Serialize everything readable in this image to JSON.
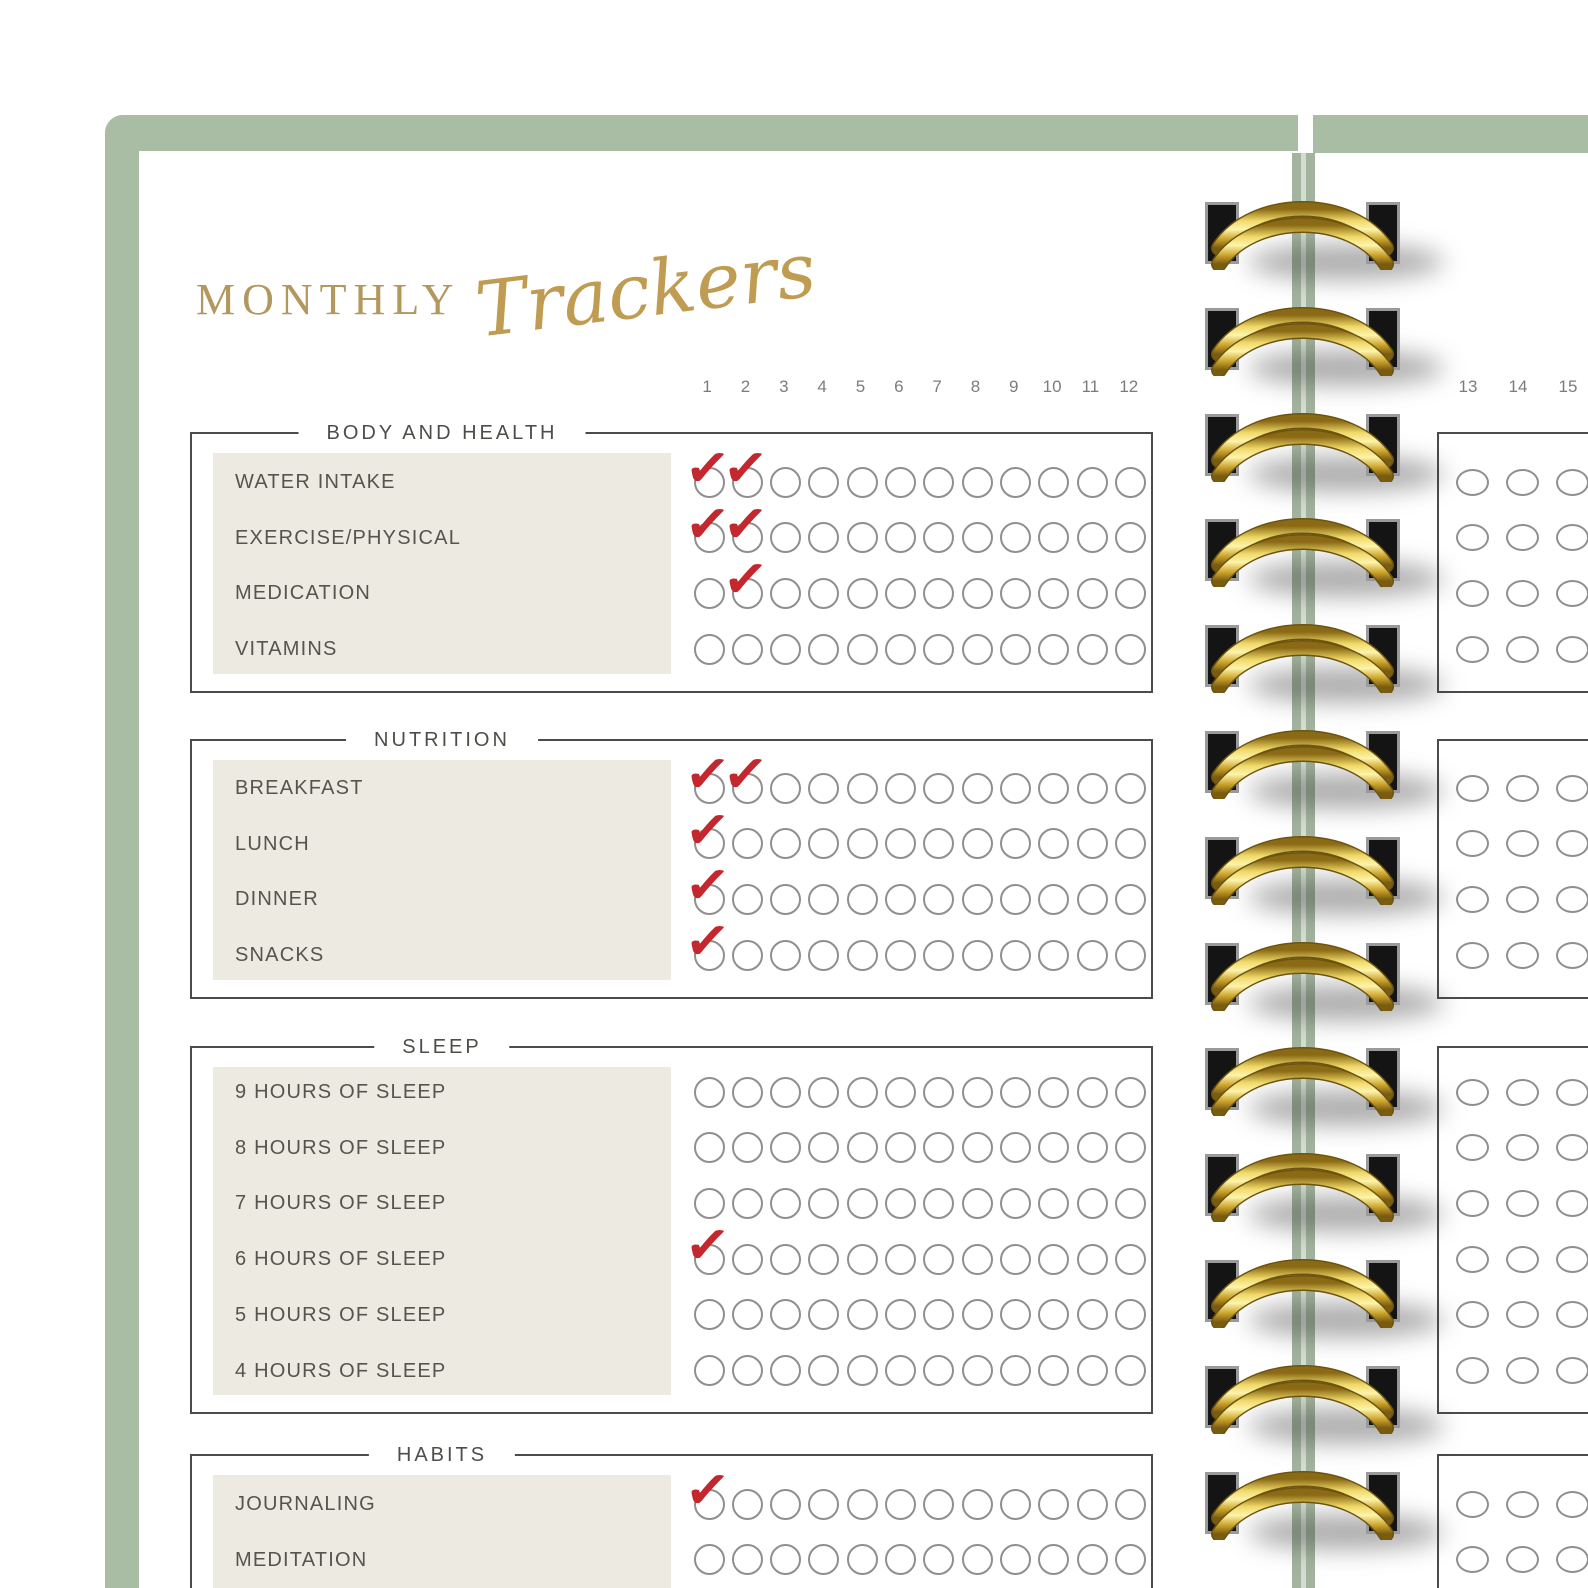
{
  "title": {
    "word_serif": "MONTHLY",
    "word_script": "Trackers"
  },
  "left_page": {
    "day_numbers": [
      "1",
      "2",
      "3",
      "4",
      "5",
      "6",
      "7",
      "8",
      "9",
      "10",
      "11",
      "12"
    ],
    "sections": [
      {
        "title": "BODY AND HEALTH",
        "rows": [
          {
            "label": "WATER INTAKE",
            "checked_days": [
              1,
              2
            ]
          },
          {
            "label": "EXERCISE/PHYSICAL",
            "checked_days": [
              1,
              2
            ]
          },
          {
            "label": "MEDICATION",
            "checked_days": [
              2
            ]
          },
          {
            "label": "VITAMINS",
            "checked_days": []
          }
        ]
      },
      {
        "title": "NUTRITION",
        "rows": [
          {
            "label": "BREAKFAST",
            "checked_days": [
              1,
              2
            ]
          },
          {
            "label": "LUNCH",
            "checked_days": [
              1
            ]
          },
          {
            "label": "DINNER",
            "checked_days": [
              1
            ]
          },
          {
            "label": "SNACKS",
            "checked_days": [
              1
            ]
          }
        ]
      },
      {
        "title": "SLEEP",
        "rows": [
          {
            "label": "9 HOURS OF SLEEP",
            "checked_days": []
          },
          {
            "label": "8 HOURS OF SLEEP",
            "checked_days": []
          },
          {
            "label": "7 HOURS OF SLEEP",
            "checked_days": []
          },
          {
            "label": "6 HOURS OF SLEEP",
            "checked_days": [
              1
            ]
          },
          {
            "label": "5 HOURS OF SLEEP",
            "checked_days": []
          },
          {
            "label": "4 HOURS OF SLEEP",
            "checked_days": []
          }
        ]
      },
      {
        "title": "HABITS",
        "rows": [
          {
            "label": "JOURNALING",
            "checked_days": [
              1
            ]
          },
          {
            "label": "MEDITATION",
            "checked_days": []
          }
        ]
      }
    ]
  },
  "right_page": {
    "day_numbers": [
      "13",
      "14",
      "15"
    ],
    "sections": [
      {
        "visible_row_count": 4
      },
      {
        "visible_row_count": 4
      },
      {
        "visible_row_count": 6
      },
      {
        "visible_row_count": 2
      }
    ]
  },
  "colors": {
    "accent_green": "#a9bca4",
    "title_gold": "#bf9c52",
    "check_red": "#c4272e",
    "label_panel_beige": "#edeae1",
    "box_border_gray": "#4b4b48",
    "spiral_gold": "#e8c84a"
  },
  "icons": {
    "check": "✓"
  }
}
